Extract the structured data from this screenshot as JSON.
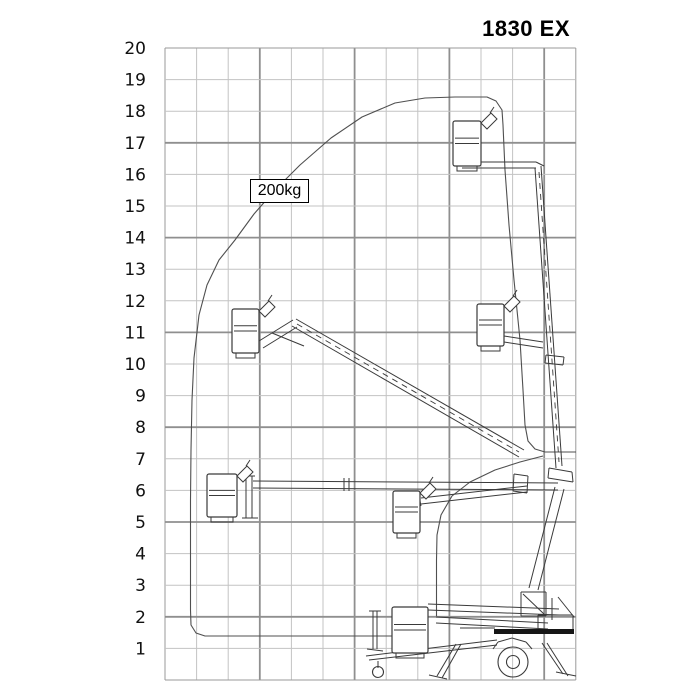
{
  "title": "1830 EX",
  "capacity_label": "200kg",
  "chart_data": {
    "type": "line",
    "title": "1830 EX",
    "subtitle": "Working range envelope diagram of trailer-mounted boom lift",
    "xlabel": "",
    "ylabel": "",
    "y_ticks": [
      20,
      19,
      18,
      17,
      16,
      15,
      14,
      13,
      12,
      11,
      10,
      9,
      8,
      7,
      6,
      5,
      4,
      3,
      2,
      1
    ],
    "ylim": [
      0,
      20
    ],
    "xlim_m": [
      0,
      13
    ],
    "grid": true,
    "legend": "none",
    "capacity": "200kg",
    "envelope_outer_m": [
      [
        7.2,
        1.4
      ],
      [
        1.3,
        1.4
      ],
      [
        0.8,
        2.0
      ],
      [
        0.8,
        7.9
      ],
      [
        0.9,
        8.9
      ],
      [
        1.1,
        11.6
      ],
      [
        1.6,
        12.8
      ],
      [
        2.8,
        14.7
      ],
      [
        4.3,
        16.3
      ],
      [
        6.2,
        17.8
      ],
      [
        8.2,
        18.4
      ],
      [
        10.2,
        18.4
      ],
      [
        10.7,
        17.6
      ],
      [
        10.9,
        15.5
      ],
      [
        11.0,
        12.5
      ],
      [
        11.3,
        9.2
      ],
      [
        11.5,
        7.6
      ],
      [
        12.0,
        7.2
      ],
      [
        13.0,
        7.2
      ]
    ],
    "envelope_inner_m": [
      [
        12.0,
        7.1
      ],
      [
        10.4,
        6.6
      ],
      [
        9.1,
        5.8
      ],
      [
        8.7,
        5.2
      ],
      [
        8.6,
        4.0
      ],
      [
        8.6,
        2.0
      ]
    ],
    "machine_positions": [
      {
        "name": "boom-vertical-telescoped",
        "basket_outreach_m": 9.1,
        "basket_floor_height_m": 16.2
      },
      {
        "name": "boom-45deg-telescoped",
        "basket_outreach_m": 2.1,
        "basket_floor_height_m": 10.3
      },
      {
        "name": "boom-vertical-retracted",
        "basket_outreach_m": 9.9,
        "basket_floor_height_m": 10.5
      },
      {
        "name": "boom-horizontal-telescoped",
        "basket_outreach_m": 1.3,
        "basket_floor_height_m": 5.1
      },
      {
        "name": "boom-retracted-mid",
        "basket_outreach_m": 7.2,
        "basket_floor_height_m": 4.7
      },
      {
        "name": "transport-stowed",
        "basket_outreach_m": 7.2,
        "basket_floor_height_m": 0.9
      }
    ],
    "render": {
      "grid": {
        "x0": 165,
        "y0": 48,
        "cell": 31.6,
        "cols": 13,
        "rows": 20,
        "vmajor": [
          3,
          6,
          9,
          12
        ],
        "hmajor": [
          3,
          6,
          9,
          12,
          15,
          18
        ],
        "minor_color": "#c3c3c3",
        "major_color": "#8f8f8f",
        "border_color": "#9a9a9a"
      },
      "ylabels": {
        "x": 146,
        "dy": 6
      },
      "outer_px": [
        [
          392,
          636
        ],
        [
          205,
          636
        ],
        [
          196,
          633
        ],
        [
          191,
          625
        ],
        [
          190.5,
          610
        ],
        [
          190.5,
          560
        ],
        [
          190.5,
          500
        ],
        [
          191,
          450
        ],
        [
          192,
          400
        ],
        [
          194,
          358
        ],
        [
          199,
          315
        ],
        [
          207,
          285
        ],
        [
          219,
          260
        ],
        [
          235,
          240
        ],
        [
          254,
          214
        ],
        [
          275,
          190
        ],
        [
          300,
          165
        ],
        [
          331,
          138
        ],
        [
          362,
          117
        ],
        [
          395,
          103
        ],
        [
          425,
          98
        ],
        [
          455,
          97
        ],
        [
          487,
          97
        ],
        [
          496,
          101
        ],
        [
          502,
          110
        ],
        [
          503,
          125
        ],
        [
          505,
          170
        ],
        [
          509,
          225
        ],
        [
          514,
          280
        ],
        [
          520,
          340
        ],
        [
          523,
          390
        ],
        [
          525,
          425
        ],
        [
          528,
          441
        ],
        [
          535,
          449
        ],
        [
          545,
          452
        ],
        [
          576,
          452
        ]
      ],
      "inner_px": [
        [
          543,
          456
        ],
        [
          520,
          462
        ],
        [
          495,
          470
        ],
        [
          470,
          482
        ],
        [
          452,
          496
        ],
        [
          441,
          515
        ],
        [
          437,
          535
        ],
        [
          436.5,
          560
        ],
        [
          436.5,
          590
        ],
        [
          436.5,
          616
        ]
      ],
      "segments": [
        [
          462,
          162,
          536,
          162
        ],
        [
          462,
          168,
          536,
          168
        ],
        [
          536,
          162,
          544,
          166
        ],
        [
          535,
          168,
          556,
          468
        ],
        [
          541,
          166,
          562,
          466
        ],
        [
          546,
          355,
          564,
          357
        ],
        [
          545,
          363,
          563,
          365
        ],
        [
          546,
          355,
          545,
          363
        ],
        [
          564,
          357,
          563,
          365
        ],
        [
          504,
          336,
          543,
          342
        ],
        [
          504,
          342,
          543,
          348
        ],
        [
          296,
          319,
          524,
          450
        ],
        [
          292,
          326,
          519,
          457
        ],
        [
          259,
          341,
          293,
          320
        ],
        [
          263,
          348,
          297,
          327
        ],
        [
          272,
          333,
          304,
          346
        ],
        [
          253,
          481,
          558,
          483
        ],
        [
          253,
          488,
          558,
          490
        ],
        [
          246,
          476,
          246,
          518
        ],
        [
          252,
          476,
          252,
          518
        ],
        [
          243,
          476,
          255,
          476
        ],
        [
          242,
          518,
          258,
          518
        ],
        [
          344,
          478,
          344,
          491
        ],
        [
          349,
          478,
          349,
          491
        ],
        [
          514,
          474,
          528,
          476
        ],
        [
          513,
          491,
          527,
          493
        ],
        [
          514,
          474,
          513,
          491
        ],
        [
          528,
          476,
          527,
          493
        ],
        [
          421,
          498,
          527,
          486
        ],
        [
          421,
          504,
          527,
          492
        ],
        [
          419,
          496,
          421,
          506
        ],
        [
          555,
          487,
          529,
          588
        ],
        [
          564,
          489,
          538,
          590
        ],
        [
          549,
          468,
          572,
          472
        ],
        [
          548,
          478,
          573,
          482
        ],
        [
          549,
          468,
          548,
          478
        ],
        [
          572,
          472,
          573,
          482
        ],
        [
          428,
          604,
          559,
          609
        ],
        [
          428,
          610,
          559,
          615
        ],
        [
          436,
          617,
          548,
          623
        ],
        [
          436,
          623,
          548,
          629
        ],
        [
          552,
          598,
          552,
          620
        ],
        [
          558,
          597,
          574,
          617
        ],
        [
          497,
          640,
          366,
          656
        ],
        [
          497,
          645,
          369,
          660
        ],
        [
          378,
          661,
          378,
          668
        ],
        [
          373,
          611,
          373,
          649
        ],
        [
          377,
          611,
          377,
          649
        ],
        [
          369,
          611,
          381,
          611
        ],
        [
          367,
          649,
          383,
          651
        ],
        [
          493,
          649,
          498,
          642
        ],
        [
          498,
          642,
          512,
          638
        ],
        [
          512,
          638,
          526,
          642
        ],
        [
          526,
          642,
          532,
          649
        ],
        [
          460,
          628,
          495,
          628
        ],
        [
          538,
          615,
          573,
          615
        ],
        [
          538,
          615,
          538,
          629
        ],
        [
          573,
          615,
          573,
          629
        ],
        [
          456,
          644,
          437,
          676
        ],
        [
          461,
          644,
          442,
          678
        ],
        [
          429,
          675,
          447,
          679
        ],
        [
          542,
          643,
          563,
          674
        ],
        [
          547,
          643,
          568,
          676
        ],
        [
          556,
          672,
          576,
          676
        ],
        [
          521,
          592,
          546,
          592
        ],
        [
          521,
          592,
          521,
          616
        ],
        [
          546,
          592,
          546,
          616
        ],
        [
          521,
          616,
          546,
          616
        ],
        [
          523,
          594,
          544,
          614
        ]
      ],
      "dashed": [
        [
          539,
          172,
          559,
          462
        ],
        [
          297,
          324,
          519,
          452
        ]
      ],
      "circles": [
        [
          513,
          662,
          15
        ],
        [
          513,
          662,
          6.5
        ],
        [
          378,
          672,
          5.5
        ]
      ],
      "bars": [
        [
          494,
          629,
          80,
          5
        ]
      ],
      "baskets": [
        {
          "x": 453,
          "y": 121,
          "w": 28,
          "h": 45,
          "flag": true
        },
        {
          "x": 232,
          "y": 309,
          "w": 27,
          "h": 44,
          "flag": true
        },
        {
          "x": 477,
          "y": 304,
          "w": 27,
          "h": 42,
          "flag": true
        },
        {
          "x": 207,
          "y": 474,
          "w": 30,
          "h": 43,
          "flag": true
        },
        {
          "x": 393,
          "y": 491,
          "w": 27,
          "h": 42,
          "flag": true
        },
        {
          "x": 392,
          "y": 607,
          "w": 36,
          "h": 46,
          "flag": false
        }
      ],
      "stroke": "#3a3a3a",
      "envelope_stroke": "#4f4f4f"
    }
  }
}
